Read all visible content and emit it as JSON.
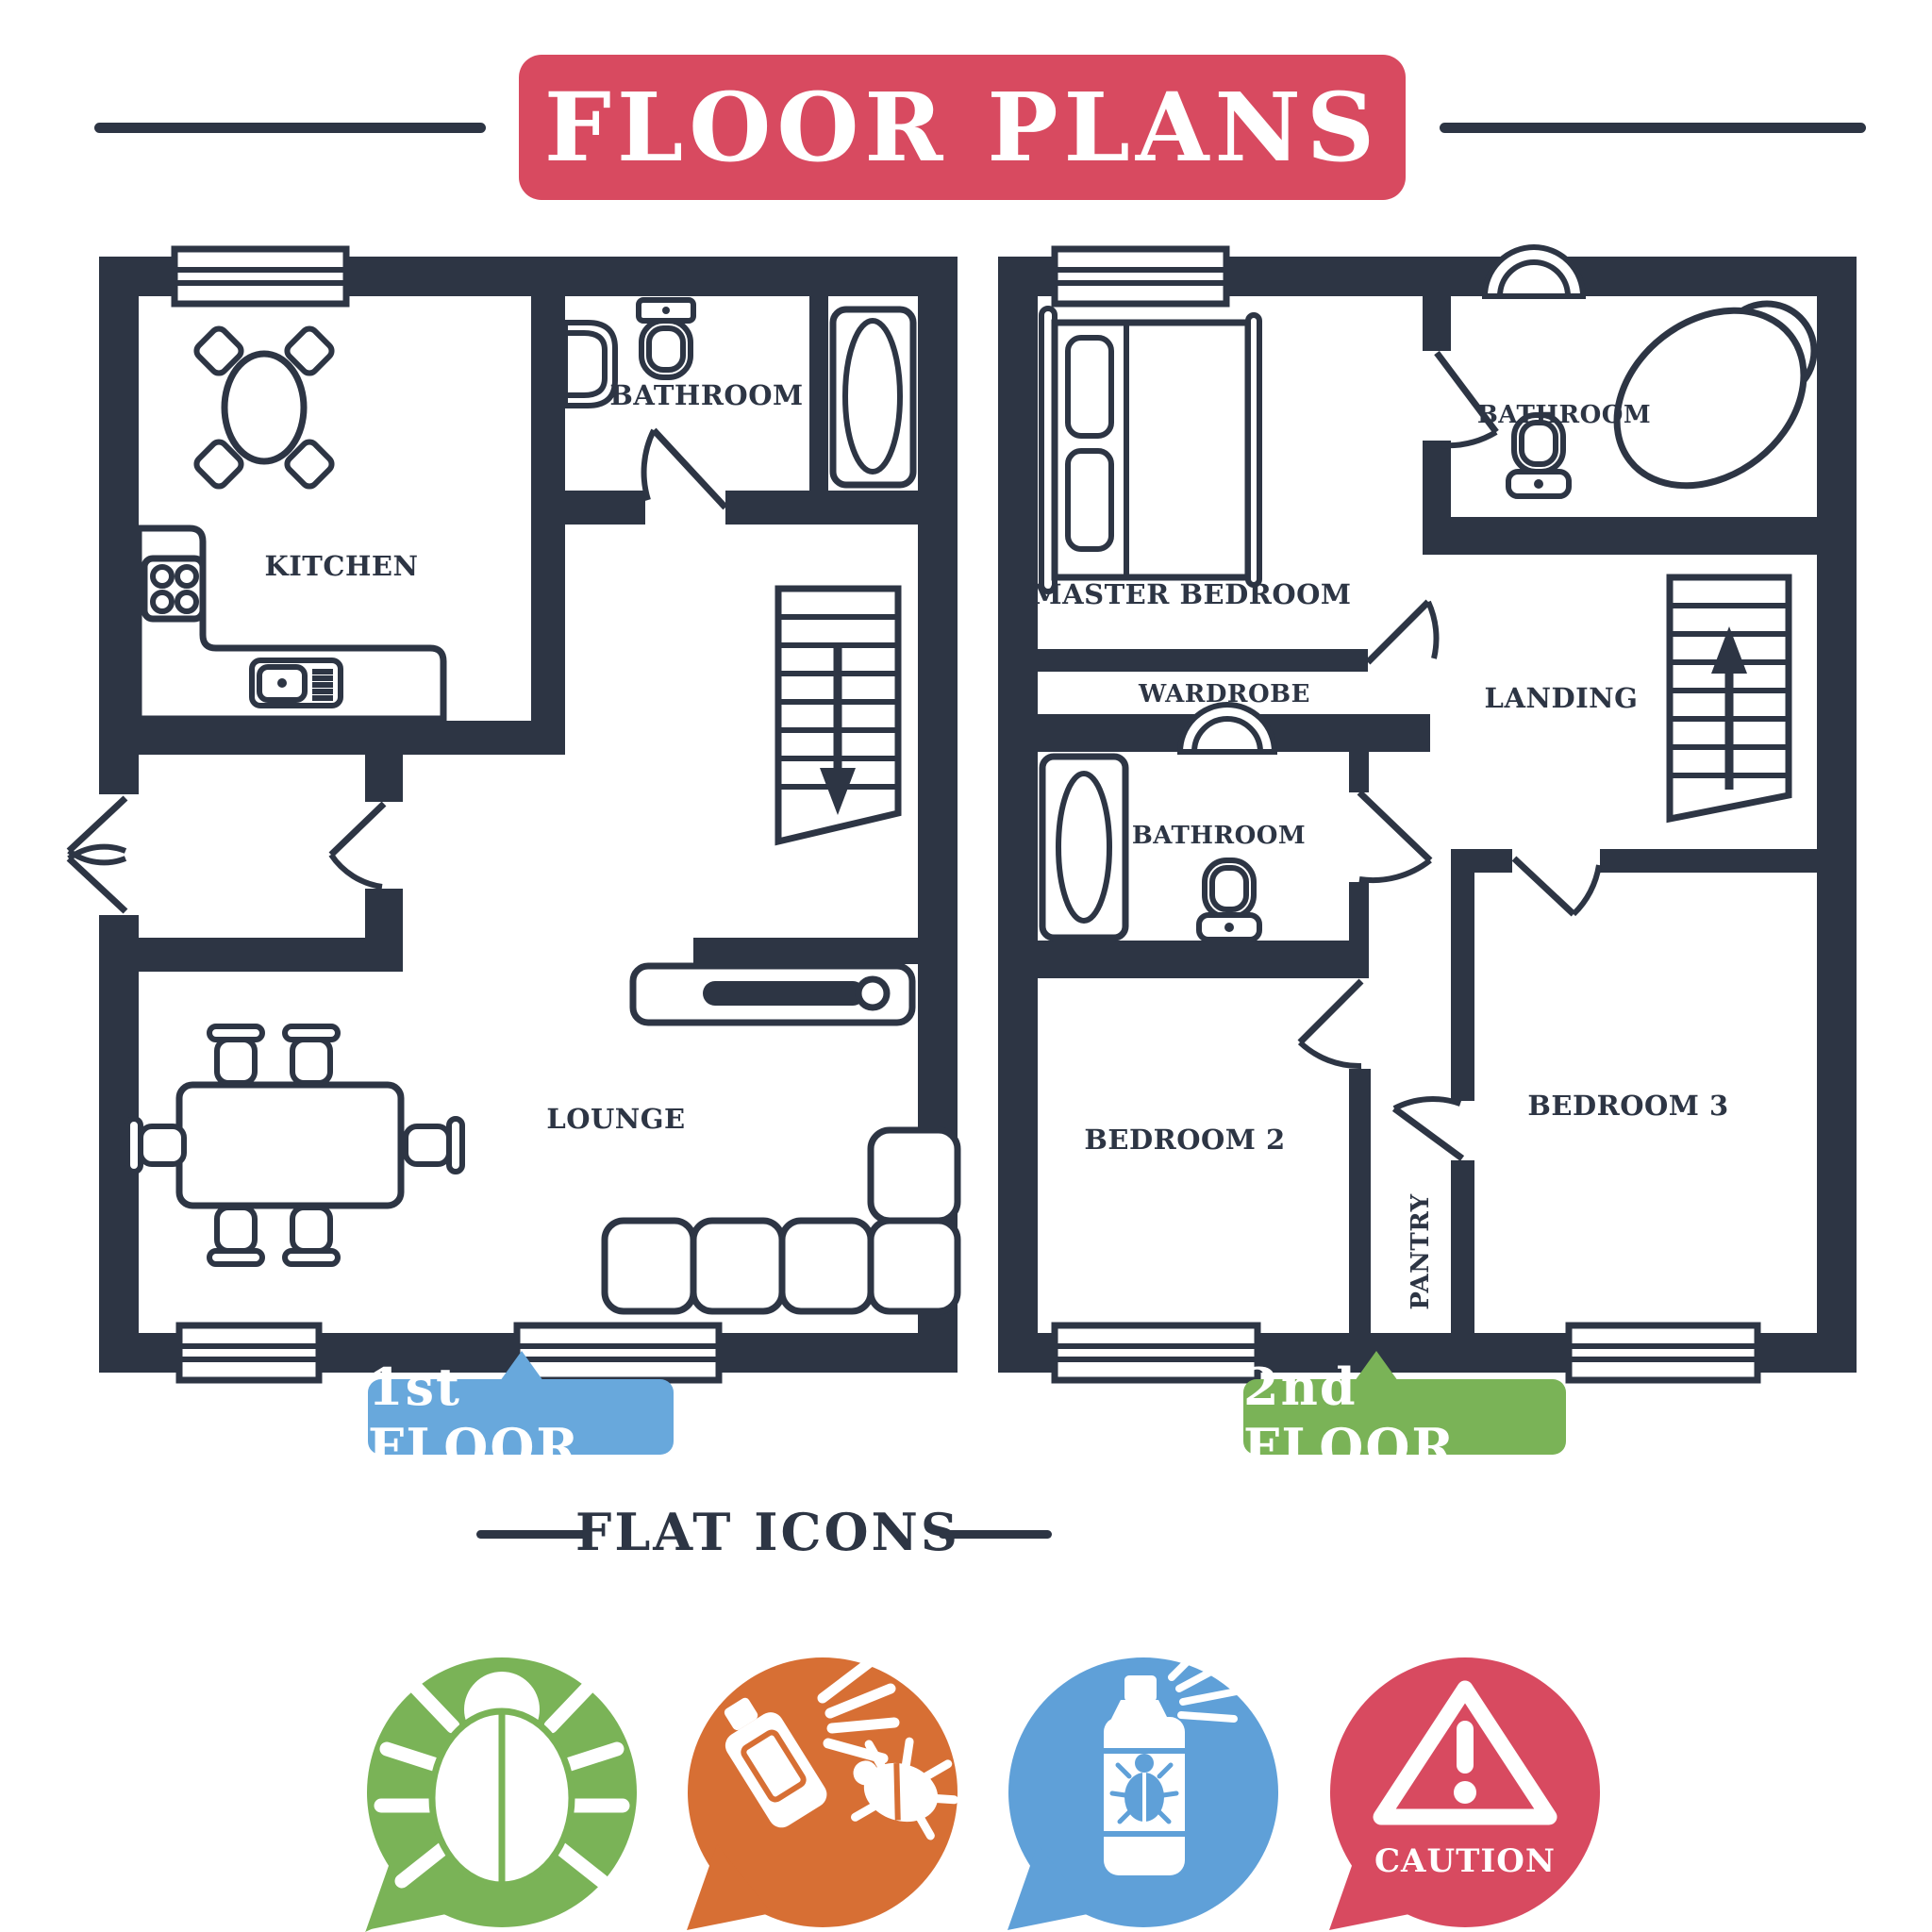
{
  "title": "FLOOR PLANS",
  "section_heading": "FLAT ICONS",
  "floor1": {
    "label": "1st FLOOR",
    "kitchen": "KITCHEN",
    "bathroom": "BATHROOM",
    "lounge": "LOUNGE"
  },
  "floor2": {
    "label": "2nd FLOOR",
    "master_bedroom": "MASTER BEDROOM",
    "bathroom_ensuite": "BATHROOM",
    "wardrobe": "WARDROBE",
    "bathroom_family": "BATHROOM",
    "landing": "LANDING",
    "bedroom2": "BEDROOM 2",
    "pantry": "PANTRY",
    "bedroom3": "BEDROOM 3"
  },
  "flat_icons": [
    {
      "name": "bug-icon",
      "color": "#7ab357"
    },
    {
      "name": "spray-bug-icon",
      "color": "#d76f34"
    },
    {
      "name": "insecticide-can-icon",
      "color": "#5fa0d8"
    },
    {
      "name": "caution-icon",
      "color": "#d84a60",
      "label": "CAUTION"
    }
  ],
  "colors": {
    "wall": "#2d3544",
    "banner": "#d84a60",
    "floor1_badge": "#68a8dc",
    "floor2_badge": "#7ab357"
  }
}
